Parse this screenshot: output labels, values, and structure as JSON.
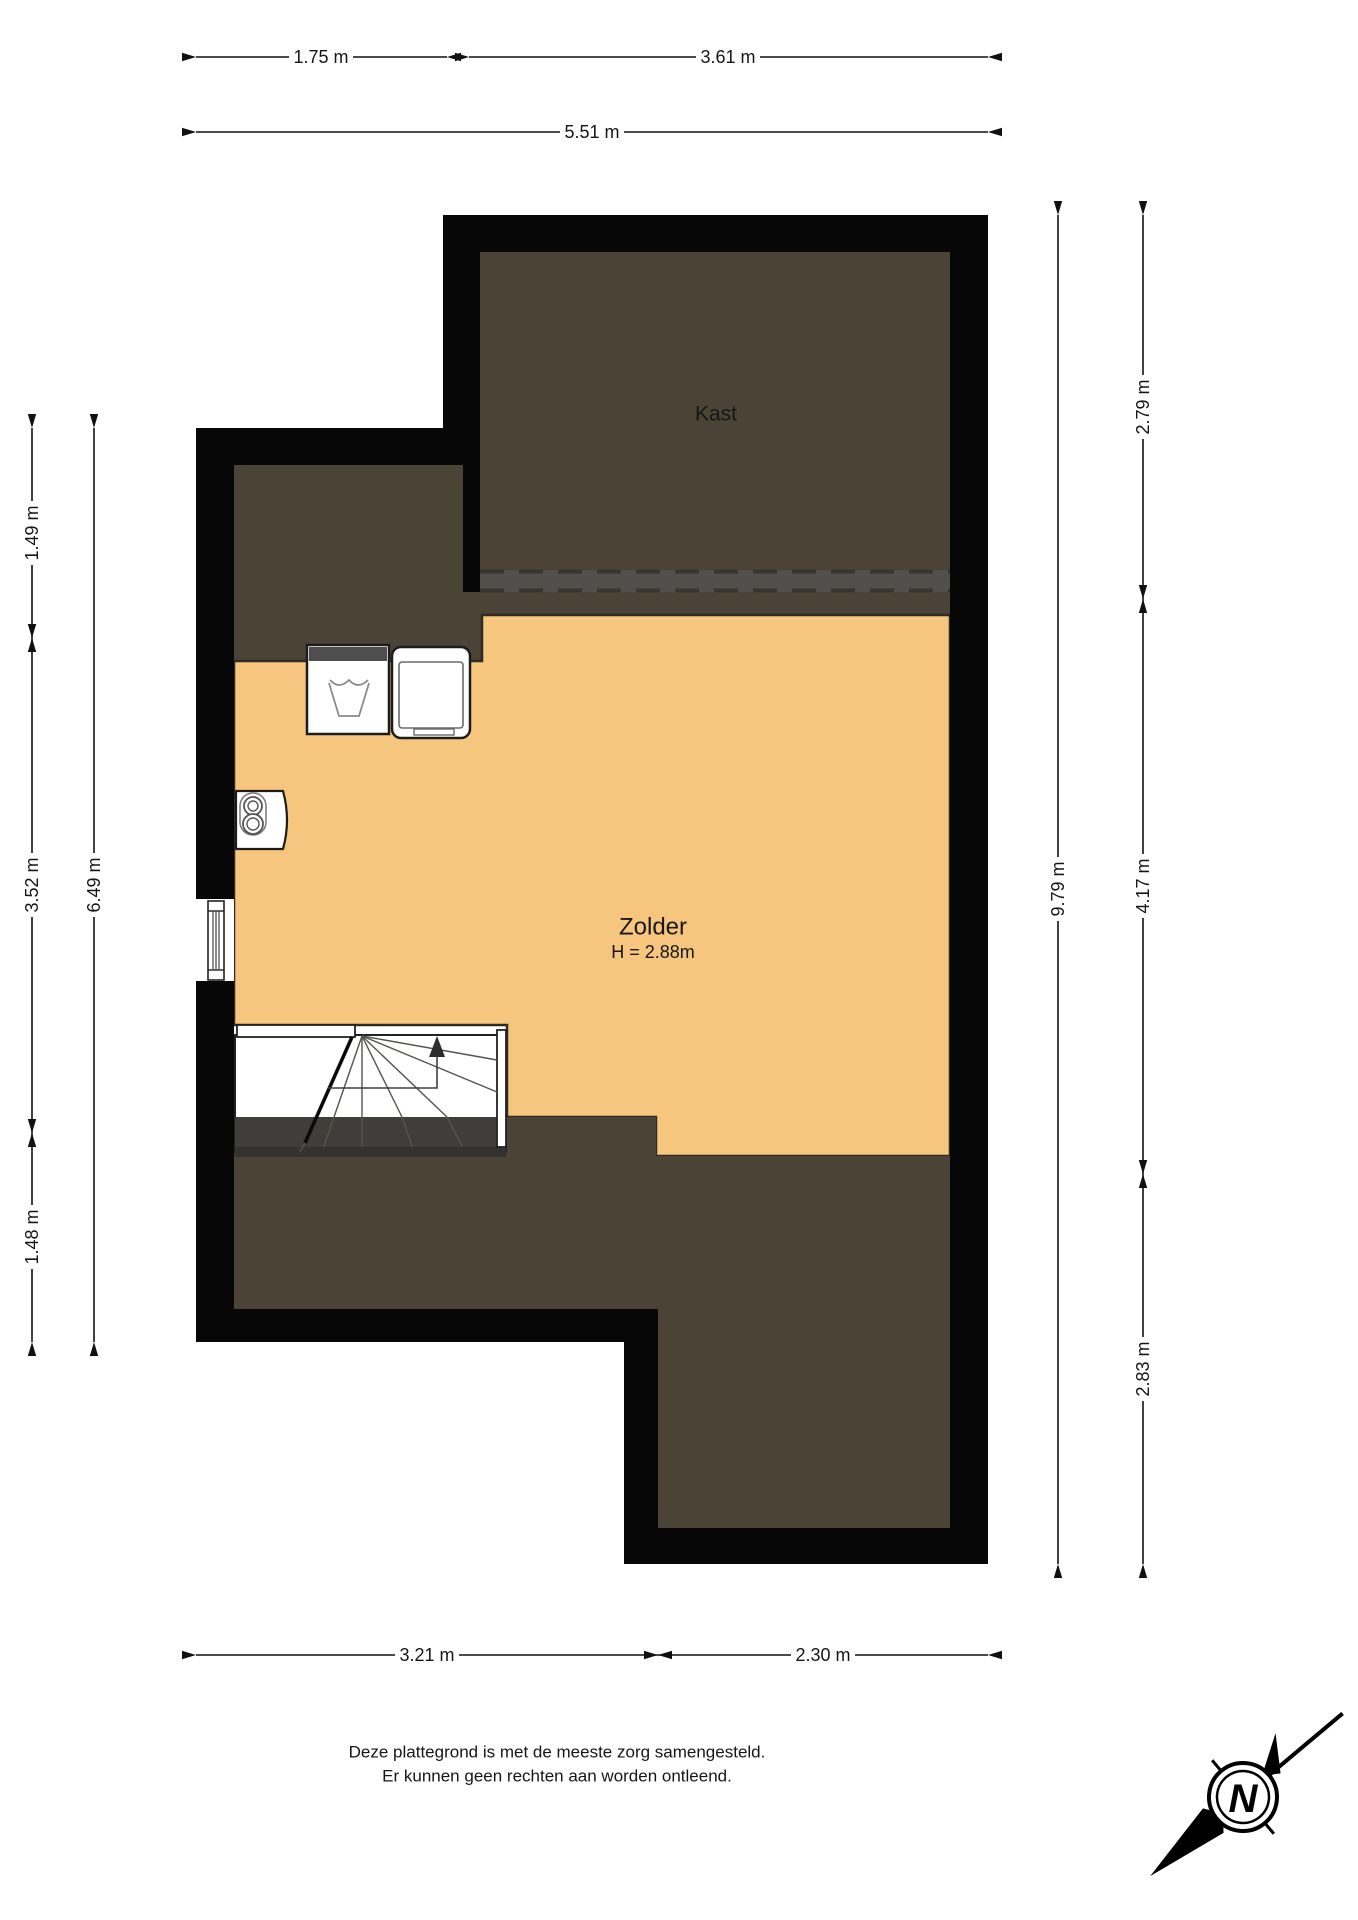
{
  "rooms": {
    "kast": {
      "label": "Kast"
    },
    "zolder": {
      "label": "Zolder",
      "height_label": "H = 2.88m"
    }
  },
  "dimensions": {
    "top": [
      {
        "label": "1.75 m"
      },
      {
        "label": "3.61 m"
      }
    ],
    "top_total": {
      "label": "5.51 m"
    },
    "left": [
      {
        "label": "1.49 m"
      },
      {
        "label": "3.52 m"
      },
      {
        "label": "1.48 m"
      }
    ],
    "left_total": {
      "label": "6.49 m"
    },
    "right": [
      {
        "label": "2.79 m"
      },
      {
        "label": "4.17 m"
      },
      {
        "label": "2.83 m"
      }
    ],
    "right_total": {
      "label": "9.79 m"
    },
    "bottom": [
      {
        "label": "3.21 m"
      },
      {
        "label": "2.30 m"
      }
    ]
  },
  "disclaimer": {
    "line1": "Deze plattegrond is met de meeste zorg samengesteld.",
    "line2": "Er kunnen geen rechten aan worden ontleend."
  },
  "compass": {
    "label": "N"
  },
  "colors": {
    "floor": "#F7C67E",
    "low_area": "#4C4337",
    "wall": "#070707",
    "knee_wall_band": "#514F4B"
  }
}
